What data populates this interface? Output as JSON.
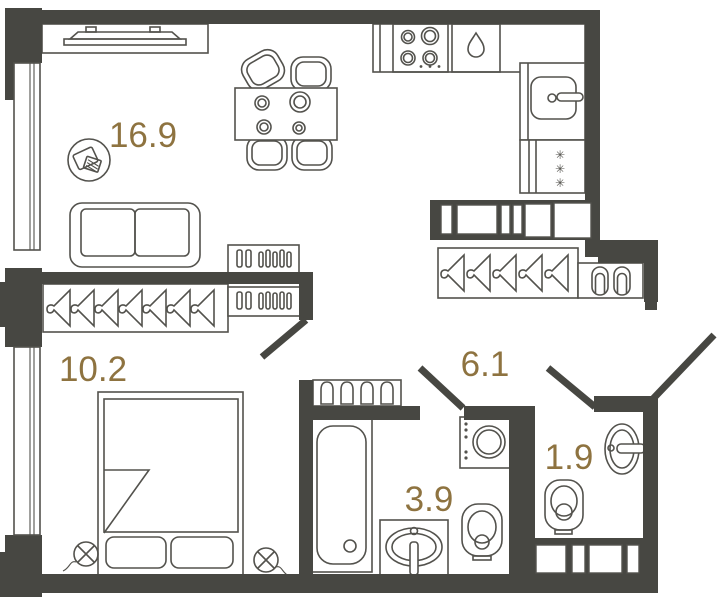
{
  "plan": {
    "type": "apartment-floorplan",
    "colors": {
      "wall": "#474742",
      "line": "#53524d",
      "label": "#8e7340",
      "background": "#ffffff"
    },
    "rooms": [
      {
        "name": "living-room",
        "area_label": "16.9"
      },
      {
        "name": "bedroom",
        "area_label": "10.2"
      },
      {
        "name": "hallway",
        "area_label": "6.1"
      },
      {
        "name": "bathroom",
        "area_label": "3.9"
      },
      {
        "name": "wc",
        "area_label": "1.9"
      }
    ],
    "icons": {
      "freezer_glyph": "✳",
      "named_shapes": [
        "water-drop-icon",
        "hanger-icon",
        "slippers-icon",
        "wall-light-icon",
        "snowflake-icon"
      ]
    },
    "fixtures": {
      "living-room": [
        "tv",
        "sofa",
        "dining-table",
        "chairs",
        "sideboard",
        "decor-table"
      ],
      "kitchen": [
        "stove",
        "dishwasher",
        "sink",
        "fridge-freezer"
      ],
      "bedroom": [
        "wardrobe-hangers",
        "dresser",
        "double-bed",
        "wall-lights"
      ],
      "hallway": [
        "wardrobe-hangers",
        "shoe-cabinet",
        "vent-shaft"
      ],
      "bathroom": [
        "bathtub",
        "vanity-sink",
        "washing-machine",
        "toilet",
        "bottle-shelf"
      ],
      "wc": [
        "toilet",
        "sink",
        "vent-shaft"
      ]
    }
  }
}
